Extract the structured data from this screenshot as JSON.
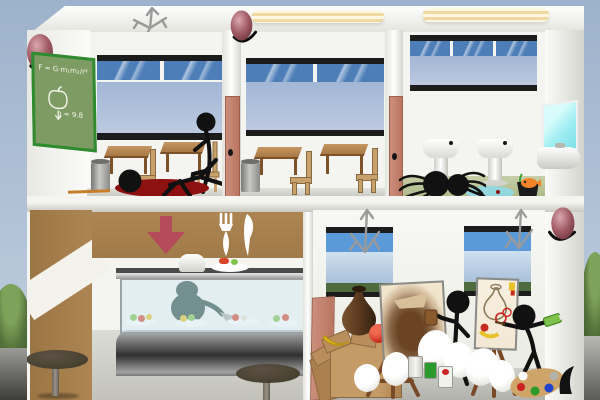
{
  "scene": {
    "description": "stickman school building cross-section game scene",
    "floors": 2
  },
  "classroom": {
    "board_line1": "F = G·m₁m₂/r²",
    "board_line2": "g = 9.8"
  },
  "rooms": [
    {
      "id": "classroom-1",
      "objects": [
        "school-bell",
        "chalkboard",
        "window",
        "desks",
        "chairs",
        "trash-can",
        "ruler",
        "sitting-stickman",
        "dead-stickman",
        "blood-pool",
        "roof-antenna"
      ]
    },
    {
      "id": "classroom-2",
      "objects": [
        "school-bell",
        "ceiling-light",
        "window",
        "desks",
        "chairs",
        "trash-can",
        "door"
      ]
    },
    {
      "id": "washroom",
      "objects": [
        "ceiling-light",
        "blinded-window",
        "pedestal-sinks",
        "mirror",
        "wall-sink",
        "spider",
        "water-puddle",
        "fish-in-pot",
        "door"
      ]
    },
    {
      "id": "cafeteria",
      "objects": [
        "down-arrow-sign",
        "cutlery-sign",
        "food-display-counter",
        "glass-case",
        "cafeteria-chef",
        "chef-hat",
        "food-plates",
        "round-tables"
      ]
    },
    {
      "id": "art-room",
      "objects": [
        "door",
        "windows",
        "roof-antennas",
        "school-bell",
        "cardboard-boxes",
        "still-life-vase",
        "apple",
        "banana",
        "easels",
        "stained-canvas",
        "vase-sketch-canvas",
        "stickman-with-mug",
        "stickman-painter",
        "paint-tube",
        "crumpled-papers",
        "paint-cans",
        "paint-palette",
        "beret"
      ]
    }
  ],
  "colors": {
    "sky-top": "#9db2cc",
    "sky-bottom": "#c3cfdf",
    "grass": "#55743c",
    "ground-dark": "#5a5a58",
    "ground-light": "#9a9a96",
    "wall-white": "#f4f4f1",
    "wall-shade": "#dededa",
    "bell-main": "#9e5660",
    "bell-light": "#dba8b0",
    "bell-dark": "#6b333c",
    "board-green": "#7e9b63",
    "board-border": "#2f8b2f",
    "chalk": "#f5f5ee",
    "window-frame": "#1c1c1c",
    "pane-blue": "#4d7eb8",
    "pane-muted": "#a3b6d6",
    "desk-wood": "#a97844",
    "desk-dark": "#7e5228",
    "chair-wood": "#c9a26b",
    "trash-gray": "#9c9c9a",
    "blood": "#8e1111",
    "stick-black": "#111111",
    "door-salmon": "#cb8f7c",
    "light-cream": "#f0d9a0",
    "bath-floor": "#a9b784",
    "sink-white": "#ededea",
    "mirror-cyan": "#9feef2",
    "puddle": "#8fd9e8",
    "fish-orange": "#f08428",
    "pot-black": "#1b1b1b",
    "plant-green": "#3aa03a",
    "cafe-tan": "#ad8552",
    "cafe-stripe": "#f4f2ec",
    "arrow-red": "#b54a5a",
    "cutlery-white": "#ffffff",
    "glass-blue": "rgba(203,229,238,0.45)",
    "chef-teal": "#2b4a42",
    "spatula-gray": "#b0b0ac",
    "table-brown": "#46402f",
    "table-top": "#5c5144",
    "art-floor": "#b2b2ad",
    "canvas-cream": "#ead9bd",
    "canvas2-cream": "#f2e8d4",
    "stain-brown": "#6b4424",
    "easel-wood": "#7a4a28",
    "box-tan": "#c49a66",
    "box-dark": "#ab7f4e",
    "box-flap": "#b98e5c",
    "apple-red": "#c62b1e",
    "banana-yellow": "#e8c228",
    "palette-tan": "#cfa468",
    "paint-red": "#cc2222",
    "paint-green": "#2a9a2a",
    "paint-blue": "#2244cc",
    "paint-white": "#ffffff",
    "tube-green": "#7cc24a",
    "mug-brown": "#8a5a2e",
    "antenna-gray": "#9a9a9a",
    "sky-pane": "#5a9ad8",
    "haze-pane": "#a9c1db",
    "hill-pane": "#4d6b3c"
  }
}
